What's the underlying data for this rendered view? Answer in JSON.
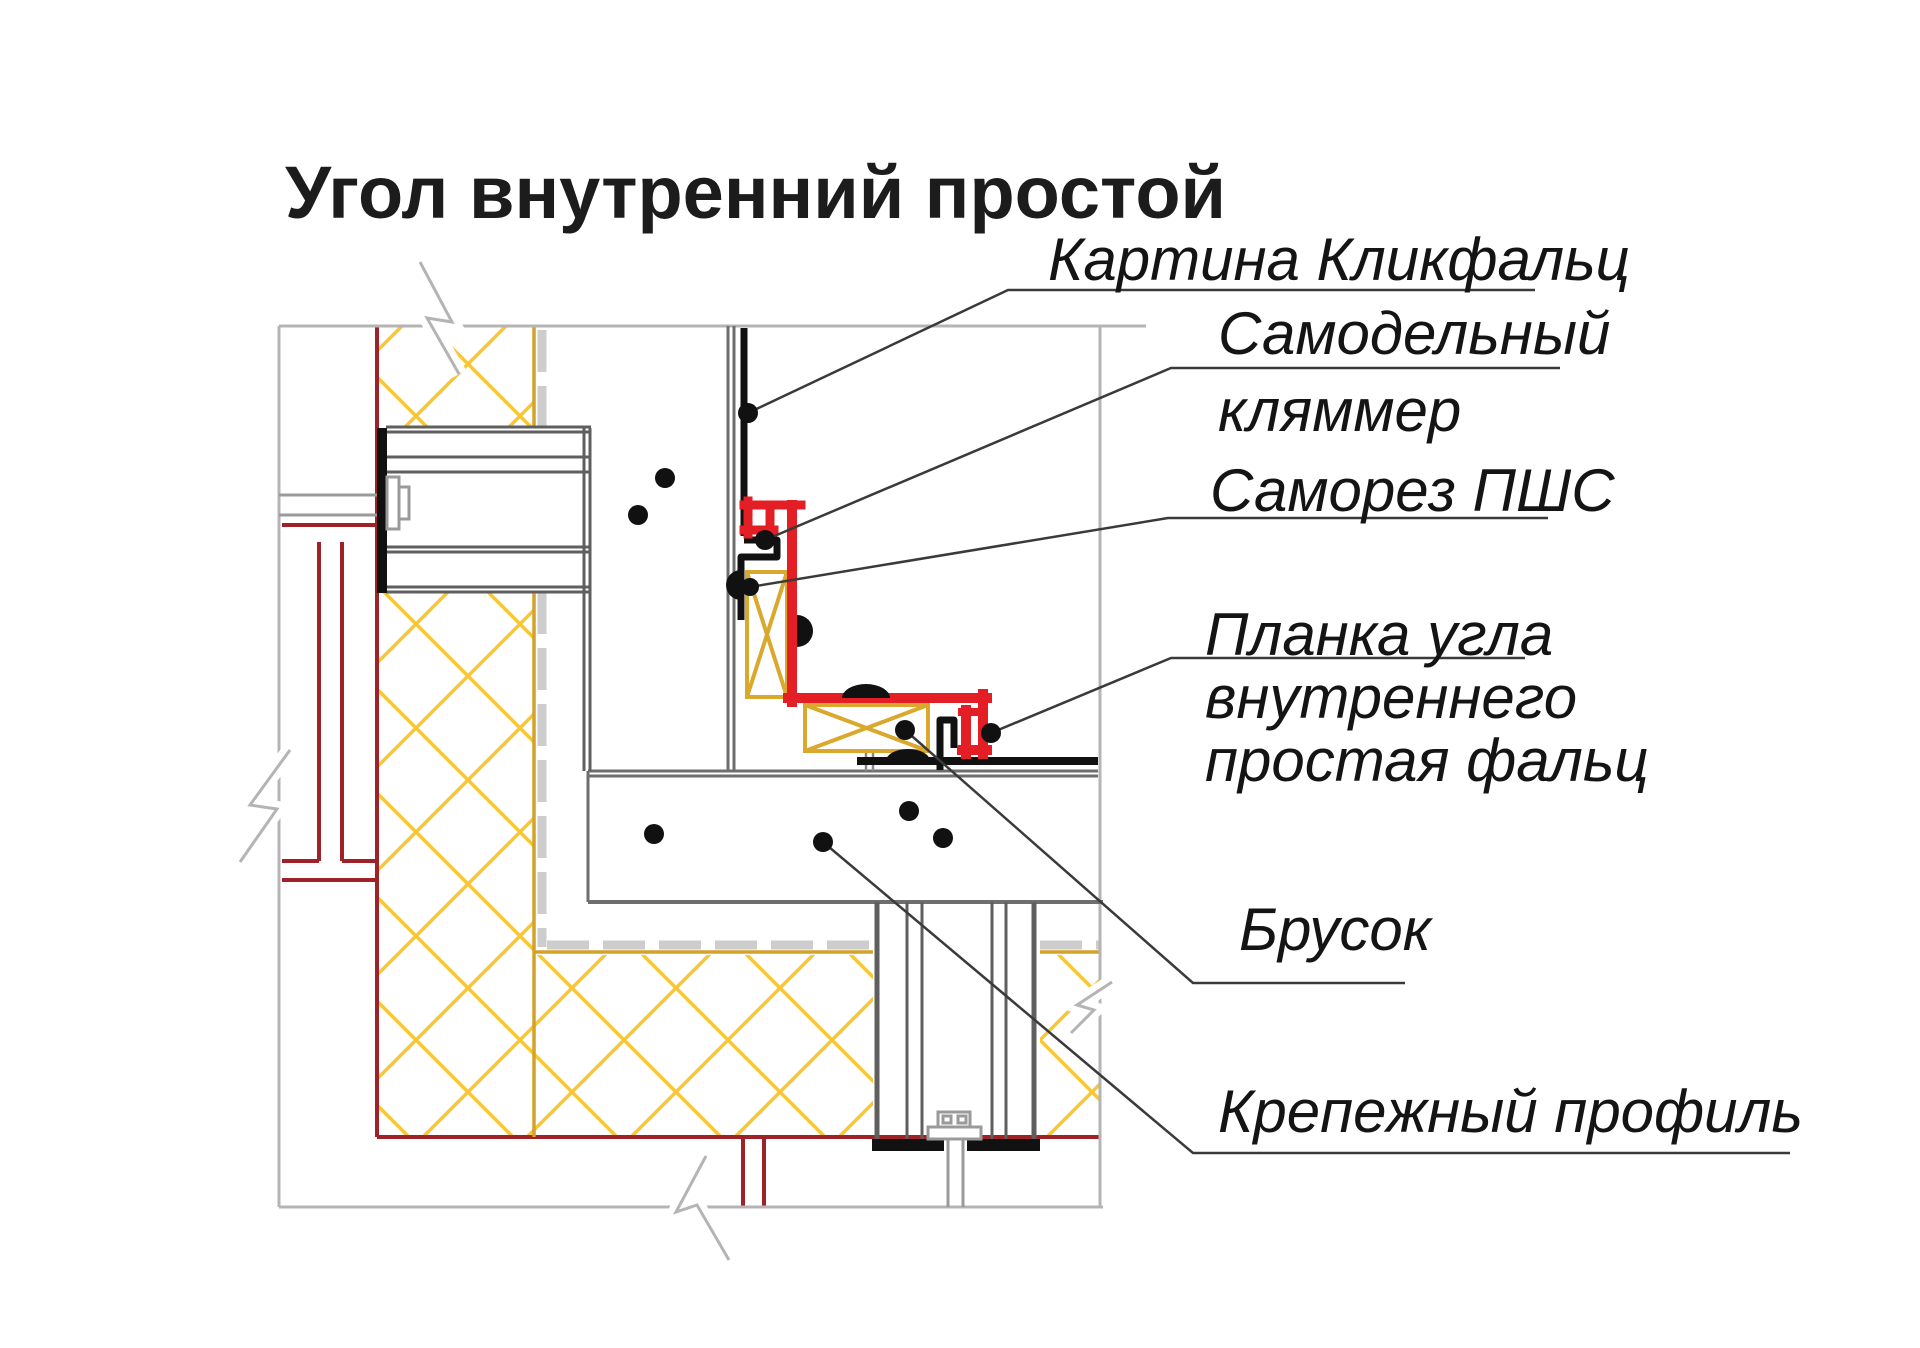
{
  "title": "Угол внутренний простой",
  "labels": {
    "panel": "Картина Кликфальц",
    "clamp1": "Самодельный",
    "clamp2": "кляммер",
    "screw": "Саморез ПШС",
    "plank1": "Планка угла",
    "plank2": "внутреннего",
    "plank3": "простая фальц",
    "bar": "Брусок",
    "profile": "Крепежный профиль"
  },
  "colors": {
    "corner_plank_red": "#e31e24",
    "membrane_dark_red": "#9e2227",
    "insulation_yellow": "#f9c636",
    "wood_ochre": "#d9a82d",
    "contour_light_gray": "#b4b4b4",
    "wall_gray": "#6e6e6e",
    "cladding_black": "#111111"
  }
}
